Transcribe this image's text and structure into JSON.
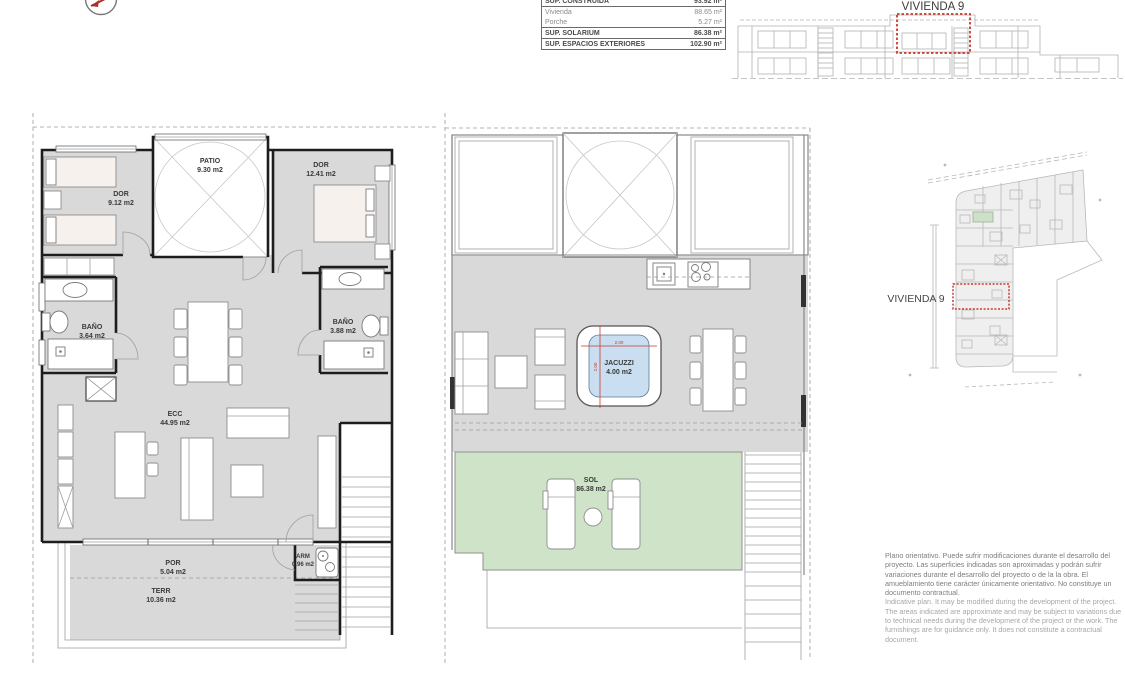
{
  "surface_table": {
    "rows": [
      {
        "label": "SUP. CONSTRUIDA",
        "value": "93.92 m²"
      },
      {
        "label": "Vivienda",
        "value": "88.65 m²"
      },
      {
        "label": "Porche",
        "value": "5.27 m²"
      },
      {
        "label": "SUP. SOLARIUM",
        "value": "86.38 m²"
      },
      {
        "label": "SUP. ESPACIOS EXTERIORES",
        "value": "102.90 m²"
      }
    ]
  },
  "elevation": {
    "title": "VIVIENDA 9"
  },
  "site_plan": {
    "label": "VIVIENDA 9"
  },
  "ground_floor": {
    "dor1": {
      "name": "DOR",
      "area": "9.12 m2"
    },
    "patio": {
      "name": "PATIO",
      "area": "9.30 m2"
    },
    "dor2": {
      "name": "DOR",
      "area": "12.41 m2"
    },
    "bano1": {
      "name": "BAÑO",
      "area": "3.64 m2"
    },
    "bano2": {
      "name": "BAÑO",
      "area": "3.88 m2"
    },
    "ecc": {
      "name": "ECC",
      "area": "44.95 m2"
    },
    "por": {
      "name": "POR",
      "area": "5.04 m2"
    },
    "terr": {
      "name": "TERR",
      "area": "10.36 m2"
    },
    "arm": {
      "name": "ARM",
      "area": "0.96 m2"
    }
  },
  "solarium": {
    "jacuzzi": {
      "name": "JACUZZI",
      "area": "4.00 m2",
      "width": "2.00",
      "depth": "2.00"
    },
    "sol": {
      "name": "SOL",
      "area": "86.38 m2"
    }
  },
  "disclaimer": {
    "es": "Plano orientativo. Puede sufrir modificaciones durante el desarrollo del proyecto. Las superficies indicadas son aproximadas y podrán sufrir variaciones durante el desarrollo del proyecto o de la la obra. El amueblamiento tiene carácter únicamente orientativo. No constituye un documento contractual.",
    "en": "Indicative plan. It may be modified during the development of the project. The areas indicated are approximate and may be subject to variations due to technical needs during the development of the project or the work. The furnishings are for guidance only. It does not constitute a contractual document."
  },
  "colors": {
    "floor_gray": "#d9d9d9",
    "sol_green": "#cfe3c8",
    "jacuzzi_blue": "#c9def1",
    "highlight_red": "#c93a2e"
  }
}
